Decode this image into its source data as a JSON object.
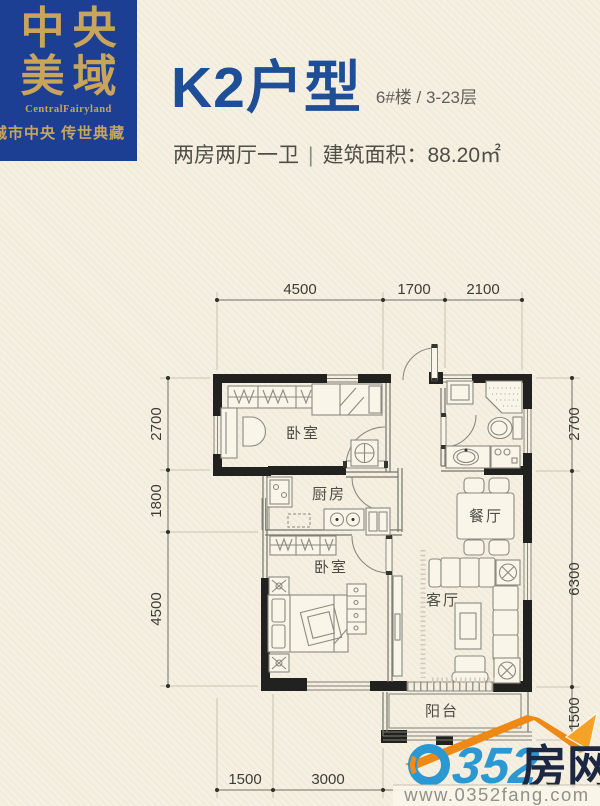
{
  "brand": {
    "line1": "中央",
    "line2": "美域",
    "name_en": "CentralFairyland",
    "tagline": "城市中央 传世典藏"
  },
  "header": {
    "title": "K2户型",
    "unit": "6#楼 / 3-23层",
    "layout": "两房两厅一卫",
    "divider": "|",
    "area": "建筑面积：88.20㎡"
  },
  "floorplan": {
    "rooms": {
      "bedroom_top": "卧室",
      "kitchen": "厨房",
      "bedroom_bottom": "卧室",
      "dining": "餐厅",
      "living": "客厅",
      "balcony": "阳台"
    },
    "dims": {
      "top": [
        "4500",
        "1700",
        "2100"
      ],
      "left": [
        "2700",
        "1800",
        "4500"
      ],
      "right": [
        "2700",
        "6300",
        "1500"
      ],
      "bottom": [
        "1500",
        "3000"
      ]
    }
  },
  "watermark": {
    "name": "0352房网",
    "digits": "352",
    "suffix": "房网",
    "url": "www.0352fang.com"
  },
  "colors": {
    "brand_blue": "#1d3f93",
    "gold": "#c9a55c",
    "title_blue": "#1e4e96",
    "wall": "#21211f",
    "cream_bg": "#f6f0e2",
    "logo_blue": "#2b97d3",
    "logo_orange": "#ee8916",
    "logo_dark": "#1c2742"
  }
}
